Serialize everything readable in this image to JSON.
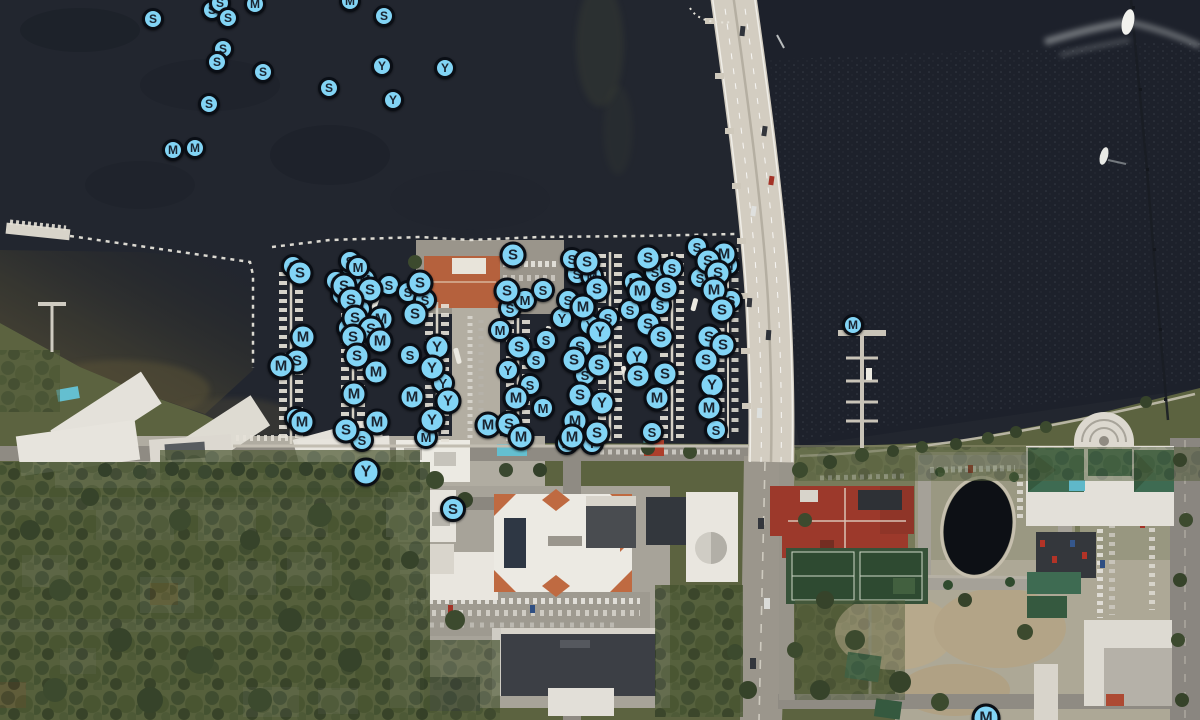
{
  "map": {
    "type": "satellite-map-with-markers",
    "visible_marker_letters": [
      "S",
      "M",
      "Y"
    ],
    "colors": {
      "marker_fill": "#82d4f5",
      "marker_ring": "#0a0e15",
      "marker_letter": "#1a2430",
      "water": "#22262f",
      "water_right": "#1d212b",
      "cove_silt": "#554f36",
      "bridge": "#d3cdc1",
      "land_green": "#55603c",
      "road": "#96928a",
      "roof_red": "#9c392b",
      "roof_orange": "#bf6a41",
      "roof_green": "#3e6b52",
      "pool": "#5fb8c9"
    },
    "icons": [
      {
        "name": "marker-s-icon",
        "glyph": "S"
      },
      {
        "name": "marker-m-icon",
        "glyph": "M"
      },
      {
        "name": "marker-y-icon",
        "glyph": "Y"
      }
    ]
  },
  "markers": [
    {
      "x": 352,
      "y": 272,
      "l": "S",
      "s": 24
    },
    {
      "x": 365,
      "y": 279,
      "l": "M",
      "s": 24
    },
    {
      "x": 342,
      "y": 295,
      "l": "S",
      "s": 24
    },
    {
      "x": 360,
      "y": 309,
      "l": "S",
      "s": 24
    },
    {
      "x": 348,
      "y": 328,
      "l": "S",
      "s": 24
    },
    {
      "x": 336,
      "y": 281,
      "l": "S",
      "s": 24
    },
    {
      "x": 389,
      "y": 285,
      "l": "S",
      "s": 24
    },
    {
      "x": 408,
      "y": 292,
      "l": "S",
      "s": 24
    },
    {
      "x": 425,
      "y": 300,
      "l": "S",
      "s": 24
    },
    {
      "x": 410,
      "y": 355,
      "l": "S",
      "s": 24
    },
    {
      "x": 443,
      "y": 383,
      "l": "Y",
      "s": 24
    },
    {
      "x": 510,
      "y": 308,
      "l": "S",
      "s": 24
    },
    {
      "x": 525,
      "y": 300,
      "l": "M",
      "s": 24
    },
    {
      "x": 536,
      "y": 360,
      "l": "S",
      "s": 24
    },
    {
      "x": 508,
      "y": 370,
      "l": "Y",
      "s": 24
    },
    {
      "x": 530,
      "y": 385,
      "l": "S",
      "s": 24
    },
    {
      "x": 543,
      "y": 290,
      "l": "S",
      "s": 24
    },
    {
      "x": 546,
      "y": 340,
      "l": "S",
      "s": 24
    },
    {
      "x": 500,
      "y": 330,
      "l": "M",
      "s": 24
    },
    {
      "x": 562,
      "y": 318,
      "l": "Y",
      "s": 24
    },
    {
      "x": 543,
      "y": 408,
      "l": "M",
      "s": 24
    },
    {
      "x": 577,
      "y": 274,
      "l": "S",
      "s": 24
    },
    {
      "x": 592,
      "y": 276,
      "l": "M",
      "s": 24
    },
    {
      "x": 568,
      "y": 300,
      "l": "S",
      "s": 24
    },
    {
      "x": 608,
      "y": 318,
      "l": "S",
      "s": 24
    },
    {
      "x": 590,
      "y": 325,
      "l": "Y",
      "s": 24
    },
    {
      "x": 585,
      "y": 375,
      "l": "S",
      "s": 24
    },
    {
      "x": 655,
      "y": 272,
      "l": "S",
      "s": 24
    },
    {
      "x": 634,
      "y": 282,
      "l": "M",
      "s": 24
    },
    {
      "x": 660,
      "y": 305,
      "l": "S",
      "s": 24
    },
    {
      "x": 672,
      "y": 268,
      "l": "S",
      "s": 24
    },
    {
      "x": 630,
      "y": 310,
      "l": "S",
      "s": 24
    },
    {
      "x": 700,
      "y": 278,
      "l": "S",
      "s": 24
    },
    {
      "x": 728,
      "y": 265,
      "l": "M",
      "s": 24
    },
    {
      "x": 718,
      "y": 258,
      "l": "S",
      "s": 24
    },
    {
      "x": 697,
      "y": 247,
      "l": "S",
      "s": 24
    },
    {
      "x": 731,
      "y": 300,
      "l": "S",
      "s": 24
    },
    {
      "x": 293,
      "y": 266,
      "l": "S",
      "s": 24
    },
    {
      "x": 296,
      "y": 418,
      "l": "M",
      "s": 24
    },
    {
      "x": 350,
      "y": 261,
      "l": "S",
      "s": 24
    },
    {
      "x": 358,
      "y": 267,
      "l": "M",
      "s": 24
    },
    {
      "x": 426,
      "y": 437,
      "l": "M",
      "s": 24
    },
    {
      "x": 362,
      "y": 440,
      "l": "S",
      "s": 24
    },
    {
      "x": 567,
      "y": 443,
      "l": "M",
      "s": 24
    },
    {
      "x": 592,
      "y": 443,
      "l": "Y",
      "s": 24
    },
    {
      "x": 572,
      "y": 259,
      "l": "S",
      "s": 24
    },
    {
      "x": 652,
      "y": 432,
      "l": "S",
      "s": 24
    },
    {
      "x": 716,
      "y": 430,
      "l": "S",
      "s": 24
    },
    {
      "x": 212,
      "y": 10,
      "l": "S",
      "s": 22
    },
    {
      "x": 153,
      "y": 19,
      "l": "S",
      "s": 22
    },
    {
      "x": 220,
      "y": 3,
      "l": "S",
      "s": 22
    },
    {
      "x": 228,
      "y": 18,
      "l": "S",
      "s": 22
    },
    {
      "x": 255,
      "y": 4,
      "l": "M",
      "s": 22
    },
    {
      "x": 350,
      "y": 1,
      "l": "M",
      "s": 22
    },
    {
      "x": 384,
      "y": 16,
      "l": "S",
      "s": 22
    },
    {
      "x": 223,
      "y": 49,
      "l": "S",
      "s": 22
    },
    {
      "x": 217,
      "y": 62,
      "l": "S",
      "s": 22
    },
    {
      "x": 263,
      "y": 72,
      "l": "S",
      "s": 22
    },
    {
      "x": 329,
      "y": 88,
      "l": "S",
      "s": 22
    },
    {
      "x": 382,
      "y": 66,
      "l": "Y",
      "s": 22
    },
    {
      "x": 393,
      "y": 100,
      "l": "Y",
      "s": 22
    },
    {
      "x": 445,
      "y": 68,
      "l": "Y",
      "s": 22
    },
    {
      "x": 209,
      "y": 104,
      "l": "S",
      "s": 22
    },
    {
      "x": 173,
      "y": 150,
      "l": "M",
      "s": 22
    },
    {
      "x": 195,
      "y": 148,
      "l": "M",
      "s": 22
    },
    {
      "x": 300,
      "y": 273,
      "l": "S"
    },
    {
      "x": 303,
      "y": 337,
      "l": "M"
    },
    {
      "x": 297,
      "y": 361,
      "l": "S"
    },
    {
      "x": 281,
      "y": 366,
      "l": "M"
    },
    {
      "x": 302,
      "y": 422,
      "l": "M"
    },
    {
      "x": 344,
      "y": 286,
      "l": "S"
    },
    {
      "x": 370,
      "y": 290,
      "l": "S"
    },
    {
      "x": 351,
      "y": 300,
      "l": "S"
    },
    {
      "x": 355,
      "y": 318,
      "l": "S"
    },
    {
      "x": 381,
      "y": 319,
      "l": "M"
    },
    {
      "x": 371,
      "y": 329,
      "l": "S"
    },
    {
      "x": 353,
      "y": 337,
      "l": "S"
    },
    {
      "x": 380,
      "y": 341,
      "l": "M"
    },
    {
      "x": 357,
      "y": 356,
      "l": "S"
    },
    {
      "x": 376,
      "y": 372,
      "l": "M"
    },
    {
      "x": 354,
      "y": 394,
      "l": "M"
    },
    {
      "x": 377,
      "y": 422,
      "l": "M"
    },
    {
      "x": 346,
      "y": 430,
      "l": "S"
    },
    {
      "x": 420,
      "y": 283,
      "l": "S"
    },
    {
      "x": 415,
      "y": 314,
      "l": "S"
    },
    {
      "x": 437,
      "y": 347,
      "l": "Y"
    },
    {
      "x": 432,
      "y": 368,
      "l": "Y"
    },
    {
      "x": 412,
      "y": 397,
      "l": "M"
    },
    {
      "x": 448,
      "y": 401,
      "l": "Y"
    },
    {
      "x": 432,
      "y": 420,
      "l": "Y"
    },
    {
      "x": 488,
      "y": 425,
      "l": "M"
    },
    {
      "x": 513,
      "y": 255,
      "l": "S"
    },
    {
      "x": 507,
      "y": 291,
      "l": "S"
    },
    {
      "x": 519,
      "y": 347,
      "l": "S"
    },
    {
      "x": 516,
      "y": 398,
      "l": "M"
    },
    {
      "x": 509,
      "y": 424,
      "l": "S"
    },
    {
      "x": 521,
      "y": 437,
      "l": "M"
    },
    {
      "x": 587,
      "y": 262,
      "l": "S"
    },
    {
      "x": 597,
      "y": 289,
      "l": "S"
    },
    {
      "x": 583,
      "y": 307,
      "l": "M"
    },
    {
      "x": 600,
      "y": 332,
      "l": "Y"
    },
    {
      "x": 580,
      "y": 347,
      "l": "S"
    },
    {
      "x": 574,
      "y": 360,
      "l": "S"
    },
    {
      "x": 599,
      "y": 365,
      "l": "S"
    },
    {
      "x": 580,
      "y": 395,
      "l": "S"
    },
    {
      "x": 602,
      "y": 403,
      "l": "Y"
    },
    {
      "x": 575,
      "y": 421,
      "l": "M"
    },
    {
      "x": 572,
      "y": 437,
      "l": "M"
    },
    {
      "x": 597,
      "y": 433,
      "l": "S"
    },
    {
      "x": 648,
      "y": 258,
      "l": "S"
    },
    {
      "x": 640,
      "y": 291,
      "l": "M"
    },
    {
      "x": 666,
      "y": 288,
      "l": "S"
    },
    {
      "x": 648,
      "y": 324,
      "l": "S"
    },
    {
      "x": 661,
      "y": 337,
      "l": "S"
    },
    {
      "x": 637,
      "y": 357,
      "l": "Y"
    },
    {
      "x": 638,
      "y": 376,
      "l": "S"
    },
    {
      "x": 665,
      "y": 374,
      "l": "S"
    },
    {
      "x": 657,
      "y": 398,
      "l": "M"
    },
    {
      "x": 724,
      "y": 254,
      "l": "M"
    },
    {
      "x": 708,
      "y": 261,
      "l": "S"
    },
    {
      "x": 718,
      "y": 273,
      "l": "S"
    },
    {
      "x": 714,
      "y": 290,
      "l": "M"
    },
    {
      "x": 722,
      "y": 310,
      "l": "S"
    },
    {
      "x": 709,
      "y": 337,
      "l": "S"
    },
    {
      "x": 723,
      "y": 345,
      "l": "S"
    },
    {
      "x": 706,
      "y": 360,
      "l": "S"
    },
    {
      "x": 712,
      "y": 385,
      "l": "Y"
    },
    {
      "x": 709,
      "y": 408,
      "l": "M"
    },
    {
      "x": 853,
      "y": 325,
      "l": "M",
      "s": 22
    },
    {
      "x": 366,
      "y": 472,
      "l": "Y",
      "s": 29
    },
    {
      "x": 453,
      "y": 509,
      "l": "S",
      "s": 26
    },
    {
      "x": 986,
      "y": 718,
      "l": "M",
      "s": 29
    }
  ]
}
